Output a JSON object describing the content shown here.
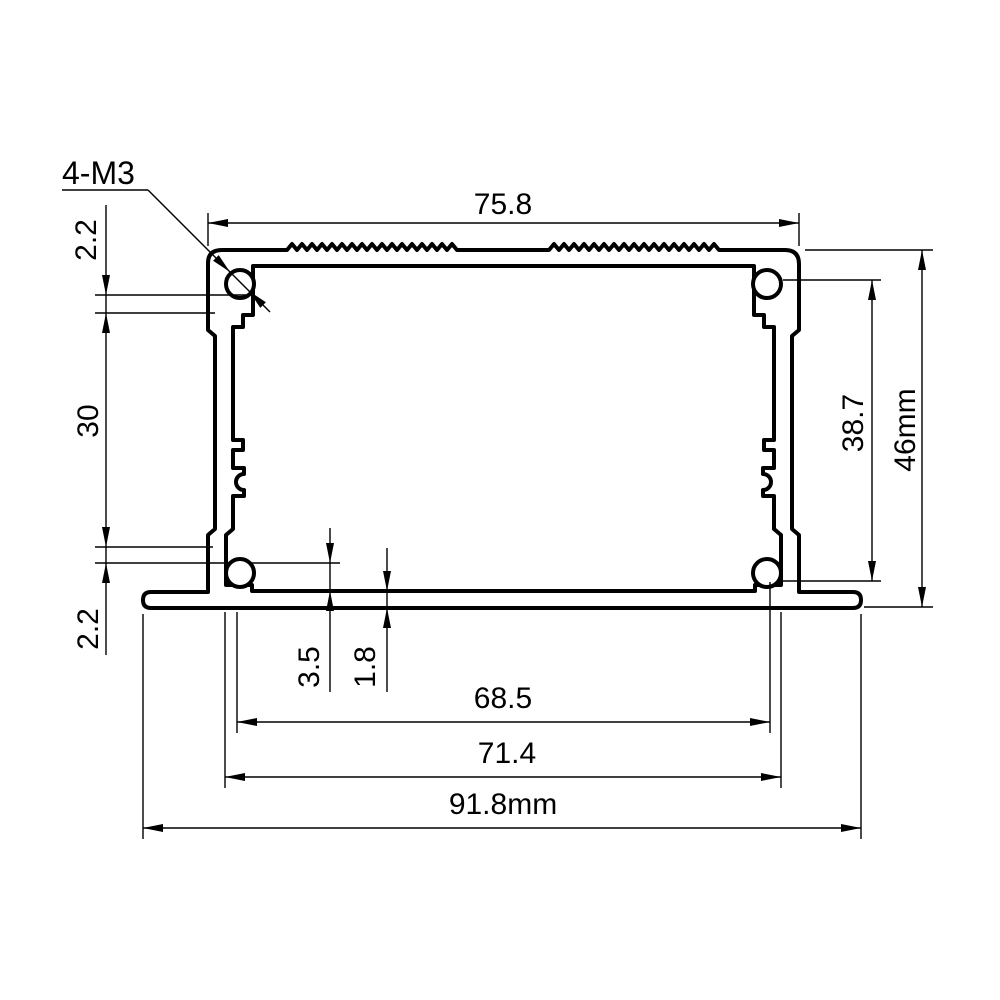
{
  "drawing": {
    "title": "Aluminum enclosure extrusion profile cross-section",
    "units": "mm",
    "callout": {
      "label": "4-M3"
    },
    "dims": {
      "top_width": "75.8",
      "corner_offset": "2.2",
      "side_mid_height": "30",
      "side_lower_step": "2.2",
      "inner_height": "38.7",
      "overall_height": "46mm",
      "ledge_height": "3.5",
      "base_thickness": "1.8",
      "inner_width": "68.5",
      "step_width": "71.4",
      "overall_width": "91.8mm"
    },
    "colors": {
      "line": "#000000",
      "background": "#ffffff"
    }
  }
}
